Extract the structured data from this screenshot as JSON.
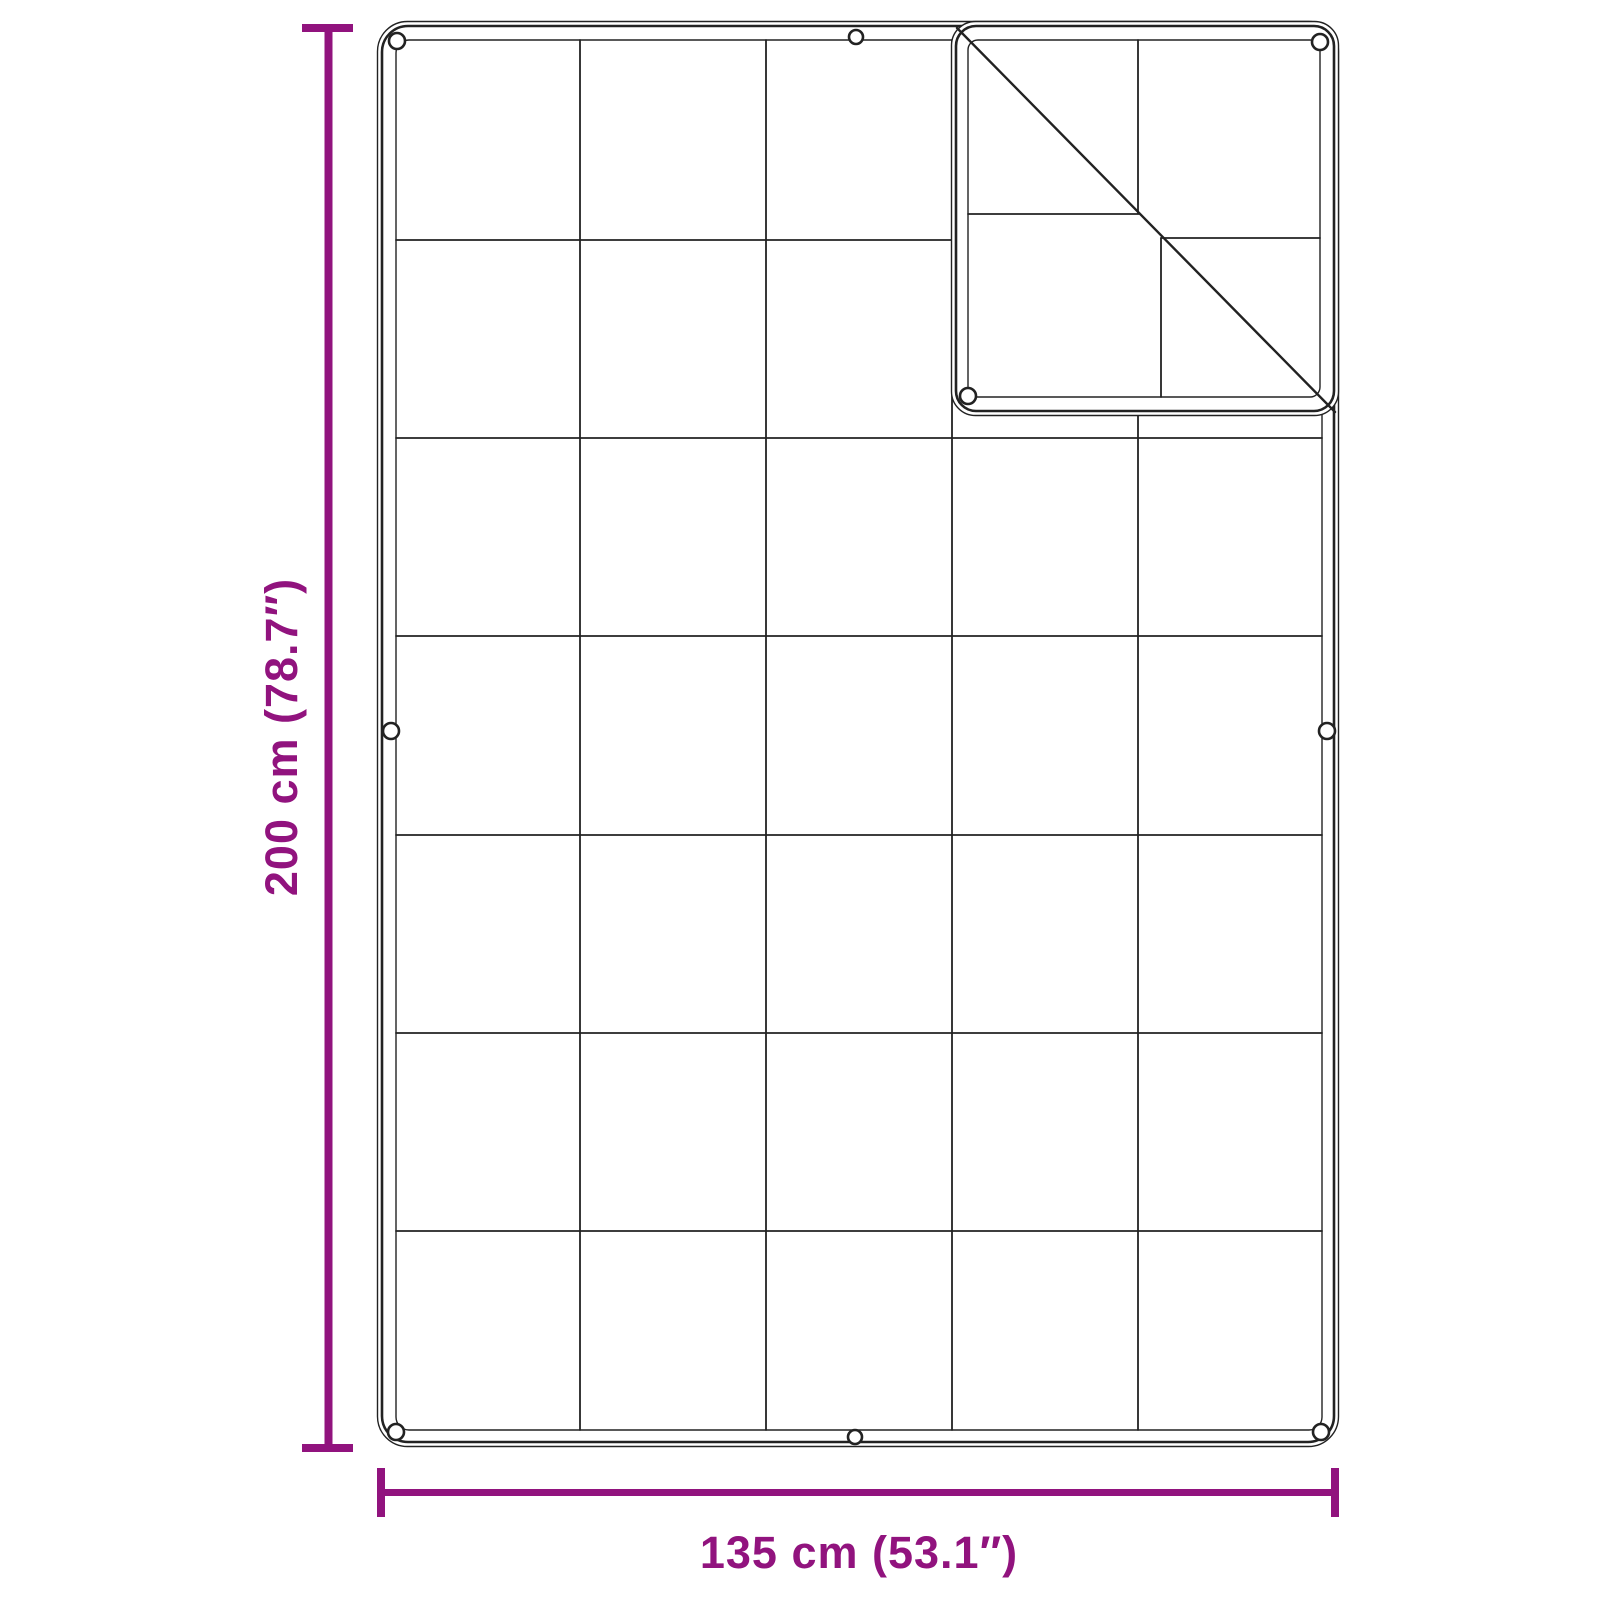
{
  "diagram": {
    "kind": "product dimension drawing",
    "subject": "tarp / ground sheet with eyelets and folded top-right corner",
    "background": "#ffffff",
    "outline_color": "#222222",
    "accent_color": "#91137E",
    "height_dimension": {
      "label": "200 cm (78.7″)",
      "side": "left"
    },
    "width_dimension": {
      "label": "135 cm (53.1″)",
      "side": "bottom"
    },
    "grid": {
      "columns": 5,
      "rows": 7
    },
    "eyelets": {
      "total_visible": 9,
      "corner": 4,
      "edge_middle": 4,
      "on_fold_flap": 2
    },
    "folded_corner": {
      "position": "top-right",
      "span": "2 columns x 2 rows",
      "fold_line": "diagonal"
    }
  }
}
